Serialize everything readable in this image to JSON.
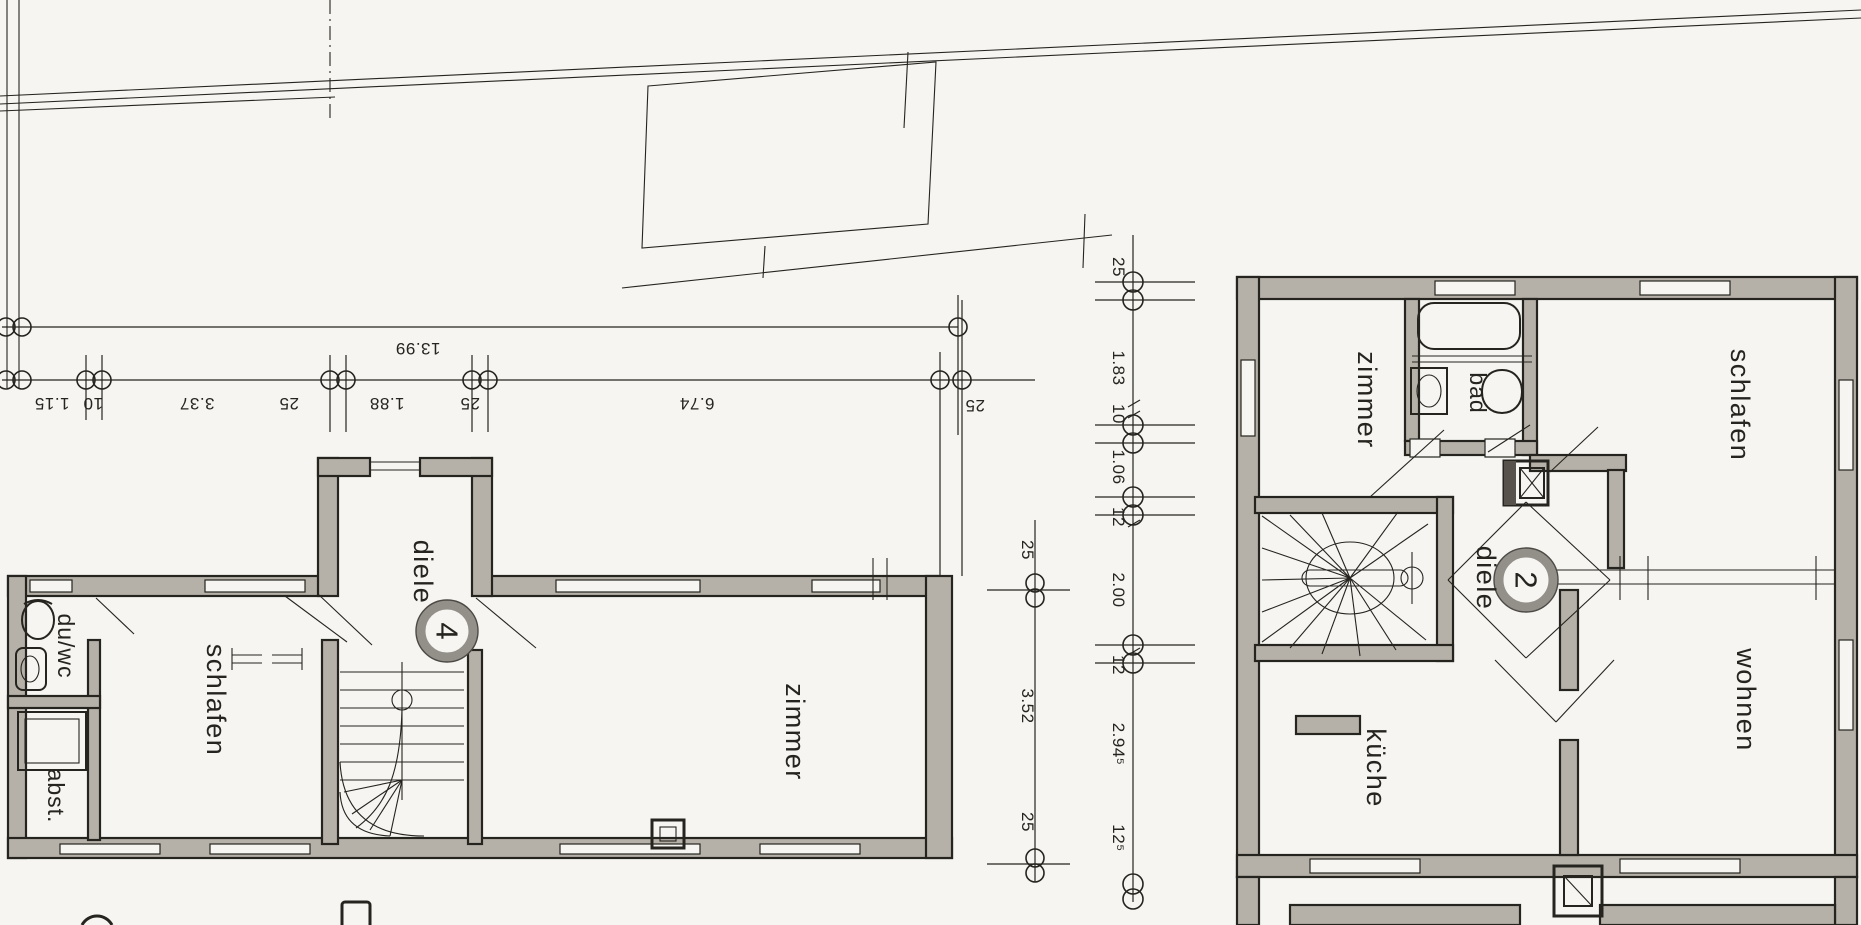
{
  "plan": {
    "left_unit": {
      "circle_number": "4",
      "rooms": {
        "abst": "abst.",
        "schlafen": "schlafen",
        "duwc": "du/wc",
        "diele": "diele",
        "zimmer": "zimmer"
      }
    },
    "right_unit": {
      "circle_number": "2",
      "rooms": {
        "zimmer": "zimmer",
        "bad": "bad",
        "schlafen": "schlafen",
        "diele": "diele",
        "wohnen": "wohnen",
        "kueche": "küche"
      }
    },
    "dimensions": {
      "h_total": "13.99",
      "h_segments": [
        "1.15",
        "10",
        "3.37",
        "25",
        "1.88",
        "25",
        "6.74",
        "25"
      ],
      "v_left": [
        "25",
        "3.52",
        "25"
      ],
      "v_right": [
        "25",
        "1.83",
        "10",
        "1.06",
        "12",
        "2.00",
        "12",
        "2.94⁵",
        "12⁵"
      ]
    },
    "colors": {
      "paper": "#f6f5f1",
      "ink": "#26241f",
      "wall": "#b6b1a8",
      "ring": "#93908a"
    }
  }
}
